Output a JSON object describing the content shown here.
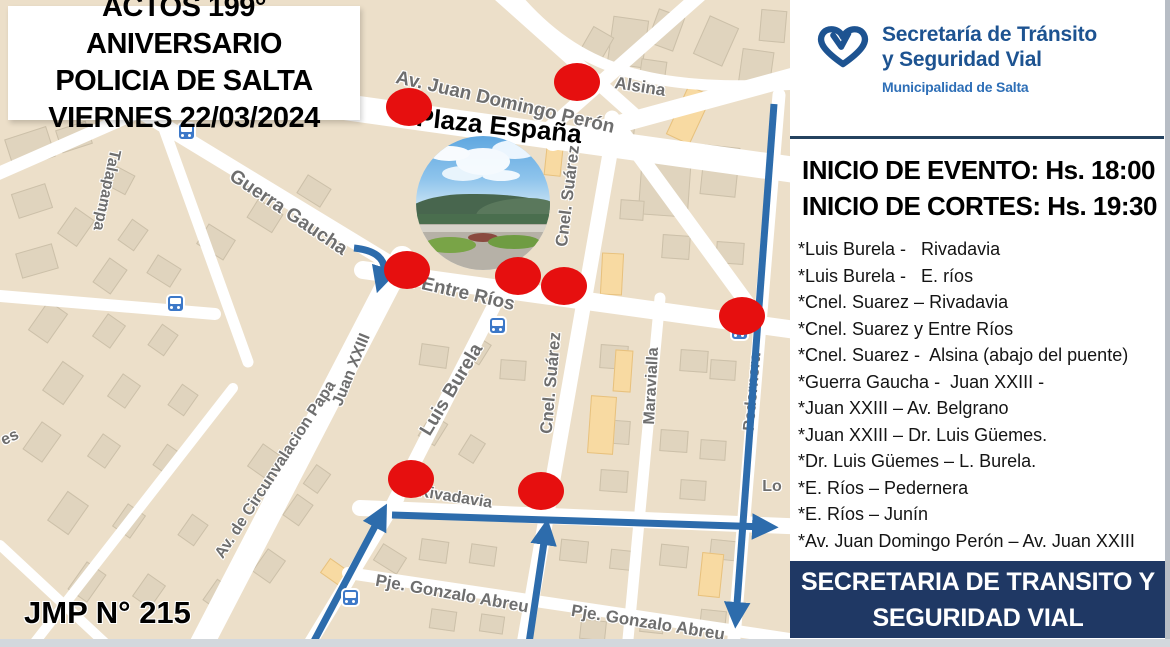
{
  "title_box": {
    "line1": "ACTOS 199° ANIVERSARIO",
    "line2": "POLICIA DE SALTA",
    "line3": "VIERNES 22/03/2024"
  },
  "logo": {
    "name_line1": "Secretaría de Tránsito",
    "name_line2": "y Seguridad Vial",
    "subtitle": "Municipalidad de Salta",
    "heart_icon": "heart-outline-icon",
    "color": "#1d5391"
  },
  "schedule": {
    "event_start": "INICIO DE EVENTO: Hs. 18:00",
    "closures_start": "INICIO DE CORTES: Hs. 19:30"
  },
  "closures": [
    "*Luis Burela -   Rivadavia",
    "*Luis Burela -   E. ríos",
    "*Cnel. Suarez – Rivadavia",
    "*Cnel. Suarez y Entre Ríos",
    "*Cnel. Suarez -  Alsina (abajo del puente)",
    "*Guerra Gaucha -  Juan XXIII -",
    "*Juan XXIII – Av. Belgrano",
    "*Juan XXIII – Dr. Luis Güemes.",
    "*Dr. Luis Güemes – L. Burela.",
    "*E. Ríos – Pedernera",
    "*E. Ríos – Junín",
    "*Av. Juan Domingo Perón – Av. Juan XXIII"
  ],
  "footer_box": {
    "line1": "SECRETARIA DE TRANSITO Y",
    "line2": "SEGURIDAD VIAL",
    "background": "#1f3864"
  },
  "jmp_label": "JMP N° 215",
  "map": {
    "plaza_label": "Plaza España",
    "closure_dot_color": "#e60f0f",
    "route_color": "#2d6cac",
    "street_labels": [
      {
        "text": "Av. Juan Domingo Perón",
        "x": 505,
        "y": 103,
        "rot": 13,
        "size": 19
      },
      {
        "text": "Alsina",
        "x": 640,
        "y": 87,
        "rot": 9,
        "size": 17
      },
      {
        "text": "Guerra Gaucha",
        "x": 288,
        "y": 213,
        "rot": 34,
        "size": 19
      },
      {
        "text": "Talapampa",
        "x": 106,
        "y": 190,
        "rot": 102,
        "size": 16
      },
      {
        "text": "Av. Entre Ríos",
        "x": 452,
        "y": 291,
        "rot": 13,
        "size": 19
      },
      {
        "text": "Cnel. Suárez",
        "x": 568,
        "y": 196,
        "rot": -83,
        "size": 17
      },
      {
        "text": "Cnel. Suárez",
        "x": 551,
        "y": 383,
        "rot": -85,
        "size": 17
      },
      {
        "text": "Luis Burela",
        "x": 452,
        "y": 390,
        "rot": -59,
        "size": 19
      },
      {
        "text": "Maravialla",
        "x": 652,
        "y": 386,
        "rot": -87,
        "size": 16
      },
      {
        "text": "Pedernera",
        "x": 753,
        "y": 392,
        "rot": -85,
        "size": 16
      },
      {
        "text": "Rivadavia",
        "x": 455,
        "y": 498,
        "rot": 9,
        "size": 16
      },
      {
        "text": "Pje. Gonzalo Abreu",
        "x": 452,
        "y": 594,
        "rot": 10,
        "size": 17
      },
      {
        "text": "Pje. Gonzalo Abreu",
        "x": 648,
        "y": 623,
        "rot": 9,
        "size": 17
      },
      {
        "text": "Av. de Circunvalacion Papa",
        "x": 276,
        "y": 470,
        "rot": -57,
        "size": 16
      },
      {
        "text": "Juan XXIII",
        "x": 352,
        "y": 370,
        "rot": -68,
        "size": 16
      },
      {
        "text": "es",
        "x": 10,
        "y": 438,
        "rot": -25,
        "size": 16
      },
      {
        "text": "Lo",
        "x": 772,
        "y": 487,
        "rot": 0,
        "size": 16
      }
    ],
    "closure_points": [
      [
        577,
        82
      ],
      [
        409,
        107
      ],
      [
        407,
        270
      ],
      [
        518,
        276
      ],
      [
        564,
        286
      ],
      [
        742,
        316
      ],
      [
        411,
        479
      ],
      [
        541,
        491
      ]
    ],
    "bus_stops": [
      [
        175,
        303
      ],
      [
        497,
        325
      ],
      [
        739,
        331
      ],
      [
        350,
        597
      ],
      [
        186,
        131
      ]
    ]
  }
}
